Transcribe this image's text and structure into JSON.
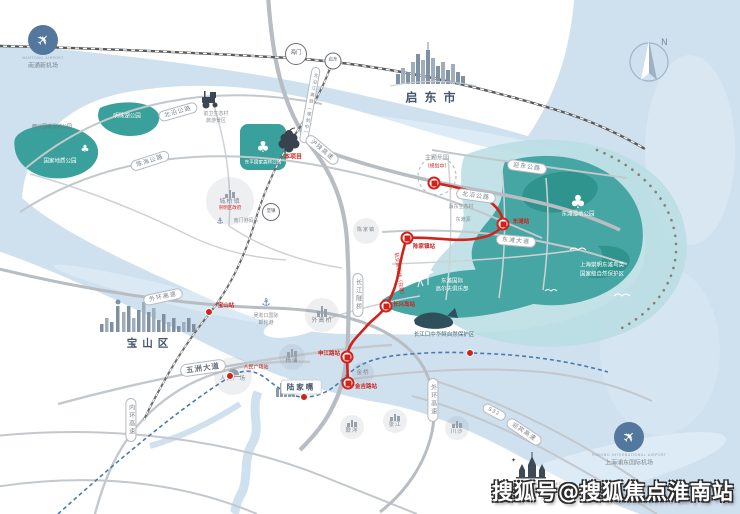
{
  "watermark": "搜狐号@搜狐焦点淮南站",
  "compass": {
    "n": "N"
  },
  "cities": {
    "qidong": "启东市",
    "baoshan": "宝山区"
  },
  "landmarks": {
    "nantong_airport_en": "NANTONG AIRPORT",
    "nantong_airport_zh": "南通新机场",
    "pudong_airport_en": "PUDONG INTERNATIONAL AIRPORT",
    "pudong_airport_zh": "上海浦东国际机场",
    "disney_en": "SHANGHAI DISNEY RESORT",
    "disney_zh": "上海迪士尼度假区",
    "wusongkou_line1": "吴淞口国际",
    "wusongkou_line2": "邮轮港",
    "nanmen_port": "南门港码头",
    "theme_park": "主题乐园",
    "theme_park_status": "（规划中）",
    "project": "本项目"
  },
  "rail": {
    "haimen": "海门",
    "qidong_station": "启东",
    "hsr_pill": "北沿江高铁（规划中）",
    "baoshan_station": "宝山站"
  },
  "metro": {
    "line_name": "轨交崇明线（在建）",
    "s_jinjilu": "金吉路站",
    "s_shenjianglu": "申江路站",
    "s_changxingdao": "长兴岛站",
    "s_chenjiazhen": "陈家镇站",
    "s_dongtan": "东滩站",
    "s_renmin": "人民广场站"
  },
  "roads": {
    "p1": "北沿公路",
    "p2": "陈海公路",
    "p3": "沪陕高速",
    "p4": "迎东公路",
    "p5": "北沿公路",
    "p6": "东滩大道",
    "p7": "五洲大道",
    "p8": "外环高速",
    "p9": "内环高速",
    "p10": "长江隧桥",
    "p11": "迎宾高速",
    "p12": "外环高速",
    "p13": "S32"
  },
  "zones": {
    "chengqiao": "城桥镇",
    "chengqiao_sub": "崇明区政府",
    "baozhen": "堡镇",
    "chenjiazhen": "陈家镇",
    "waigaoqiao": "外高桥",
    "yangpu": "杨浦",
    "renmin_sq": "人民广场",
    "jinqiao": "金桥",
    "lianyang": "联洋",
    "zhangjiang": "张江",
    "chuansha": "川沙",
    "lujiazui": "陆家嘴"
  },
  "parks": {
    "mingzhu": "明珠湖公园",
    "xisha": "西沙国家湿地公园",
    "geo": "国家地质公园",
    "dongping": "东平国家森林公园",
    "dongtan_wetland": "东滩湿地公园",
    "reserve1": "上海崇明东滩鸟类",
    "reserve2": "国家级自然保护区",
    "golf1": "东滩国际",
    "golf2": "高尔夫俱乐部",
    "sturgeon": "长江口中华鲟自然保护区",
    "qianwei1": "前卫生态村",
    "qianwei2": "旅游景区",
    "yingdong": "瀛东生态村",
    "dongtanyuan": "东滩源"
  }
}
